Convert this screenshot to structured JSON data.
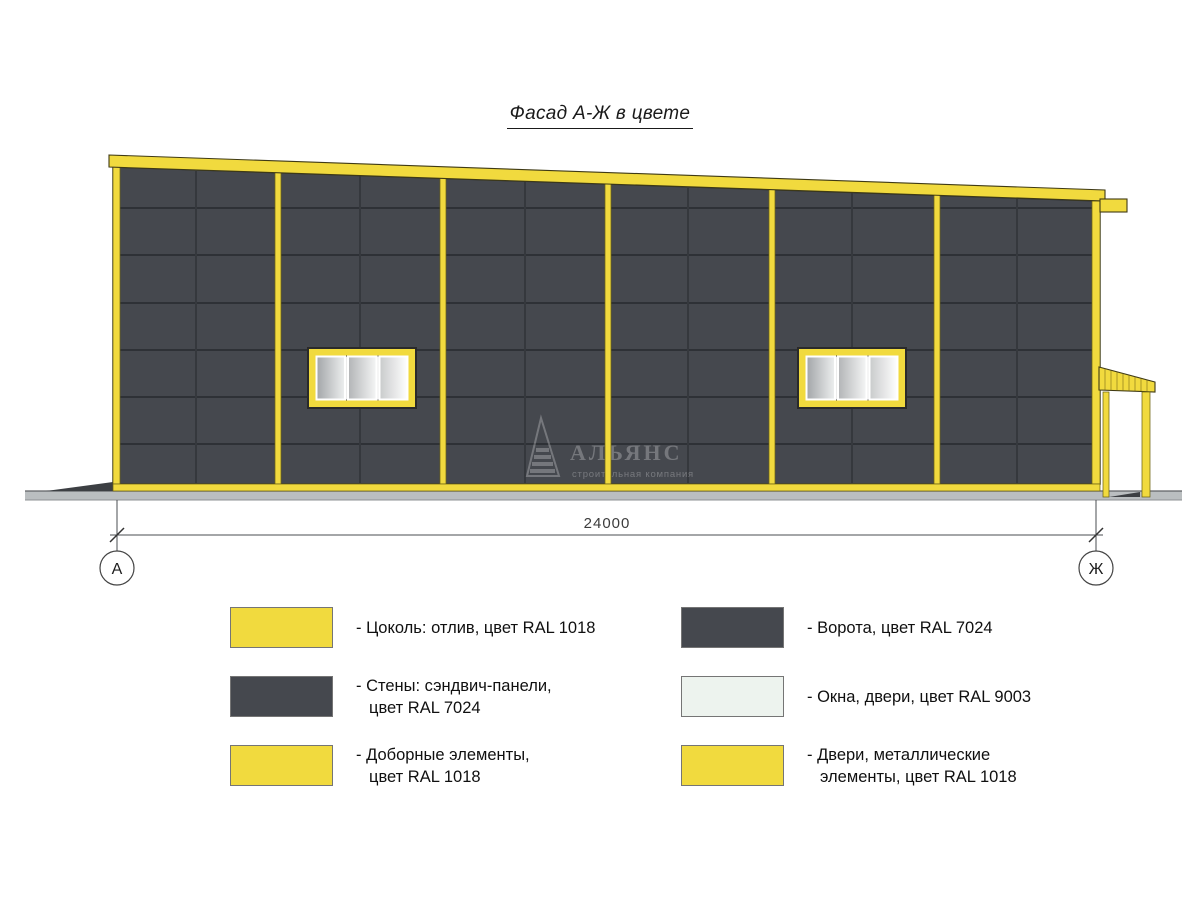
{
  "title": "Фасад А-Ж в цвете",
  "drawing": {
    "dimension_label": "24000",
    "axis_left": "А",
    "axis_right": "Ж",
    "watermark": {
      "name": "АЛЬЯНС",
      "subtitle": "строительная компания"
    }
  },
  "colors": {
    "accent_yellow": "#F1DA3E",
    "wall_dark": "#45484E",
    "window_white": "#EDF3EE",
    "ground_gray": "#BABEC0"
  },
  "legend": {
    "columns": [
      {
        "items": [
          {
            "color": "#F1DA3E",
            "ral": "RAL 1018",
            "lines": [
              "- Цоколь: отлив, цвет RAL 1018"
            ]
          },
          {
            "color": "#45484E",
            "ral": "RAL 7024",
            "lines": [
              "- Стены: сэндвич-панели,",
              "цвет RAL 7024"
            ]
          },
          {
            "color": "#F1DA3E",
            "ral": "RAL 1018",
            "lines": [
              "- Доборные элементы,",
              "цвет RAL 1018"
            ]
          }
        ]
      },
      {
        "items": [
          {
            "color": "#45484E",
            "ral": "RAL 7024",
            "lines": [
              "- Ворота, цвет RAL 7024"
            ]
          },
          {
            "color": "#EDF3EE",
            "ral": "RAL 9003",
            "lines": [
              "- Окна, двери, цвет RAL 9003"
            ]
          },
          {
            "color": "#F1DA3E",
            "ral": "RAL 1018",
            "lines": [
              "- Двери, металлические",
              "элементы, цвет RAL 1018"
            ]
          }
        ]
      }
    ]
  }
}
